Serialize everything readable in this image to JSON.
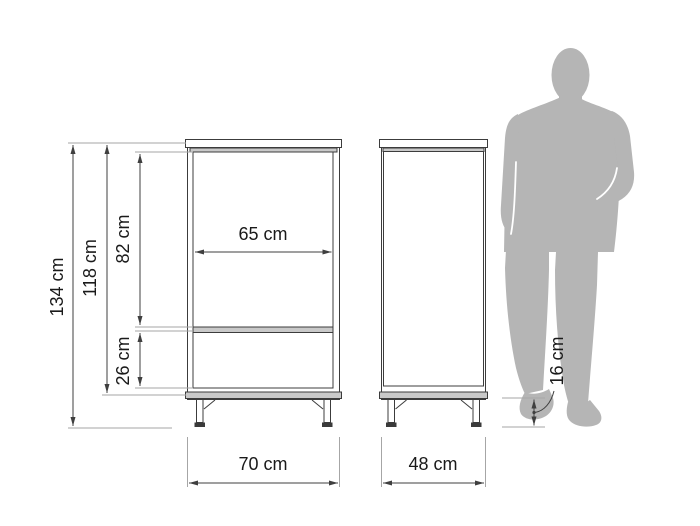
{
  "diagram": {
    "type": "furniture-dimension-drawing",
    "views": {
      "front": "cabinet front view",
      "side": "cabinet side view"
    },
    "scale_figure": "adult man silhouette",
    "dimensions": {
      "total_height": {
        "label": "134 cm"
      },
      "body_height": {
        "label": "118 cm"
      },
      "upper_section": {
        "label": "82 cm"
      },
      "lower_section": {
        "label": "26 cm"
      },
      "inner_width": {
        "label": "65 cm"
      },
      "total_width": {
        "label": "70 cm"
      },
      "depth": {
        "label": "48 cm"
      },
      "leg_height": {
        "label": "16 cm"
      }
    },
    "colors": {
      "background": "#ffffff",
      "drawing_line": "#3c3c3c",
      "dimension_line": "#3f3f3f",
      "extension_line": "#a6a6a6",
      "panel_fill": "#c9c9c9",
      "silhouette": "#b5b5b5",
      "text": "#1a1a1a"
    }
  }
}
